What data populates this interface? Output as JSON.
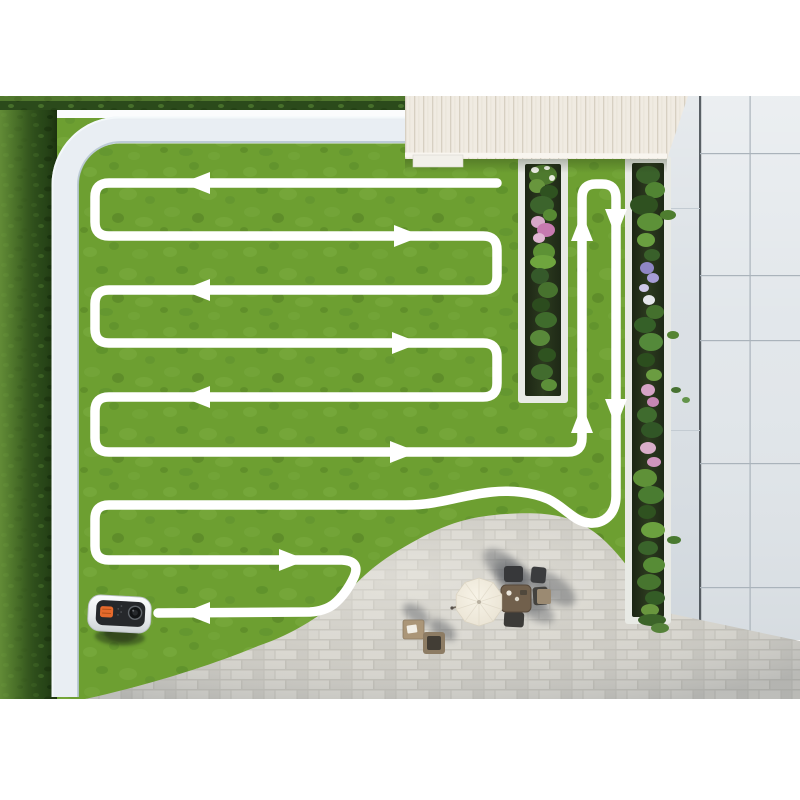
{
  "scene": {
    "description": "Aerial 3D render of a backyard showing a robotic lawn mower's serpentine mowing route",
    "frame": {
      "top": 96,
      "bottom": 699,
      "left": 0,
      "right": 800
    }
  },
  "colors": {
    "background": "#ffffff",
    "lawn": "#71a534",
    "hedge_dark": "#2b4a1b",
    "hedge_light": "#74a13f",
    "curb": "#e9eef3",
    "curb_edge": "#b6c5d1",
    "roof": "#f0ebe2",
    "roof_stripe": "#d7d0c2",
    "tile_pavement": "#e1e6ea",
    "tile_joint": "#aab3bb",
    "tile_dark_edge": "#3f464c",
    "paver_base": "#d0cec7",
    "bed_border": "#e8eae5",
    "bed_soil": "#242f1b",
    "flower_pink": "#c77ab0",
    "flower_purple": "#9a8fd0",
    "flower_white": "#eef0e8",
    "path_white": "#ffffff",
    "mower_body": "#f2f4f5",
    "mower_panel": "#26282b",
    "mower_button_orange": "#e66a2c",
    "umbrella": "#ece6d7",
    "furniture_dark": "#3b3c3e",
    "furniture_wood": "#ab9678"
  },
  "mowing_path": {
    "stroke_width": 9.5,
    "color": "#ffffff",
    "d": "M 497 183 L 109 183 Q 95 183 95 197 L 95 222 Q 95 236 109 236 L 483 236 Q 497 236 497 250 L 497 276 Q 497 290 483 290 L 109 290 Q 95 290 95 304 L 95 329 Q 95 343 109 343 L 483 343 Q 497 343 497 357 L 497 383 Q 497 397 483 397 L 109 397 Q 95 397 95 411 L 95 438 Q 95 452 109 452 L 568 452 Q 582 452 582 438 L 582 198 Q 582 184 596 184 L 602 184 Q 616 184 616 198 L 616 496 C 616 514 604 524 590 523 C 574 522 566 508 548 499 C 532 492 510 490 492 492 C 470 494 452 500 432 503 Q 420 505 406 505 L 109 505 Q 95 505 95 519 L 95 546 Q 95 560 109 560 L 342 560 Q 361 561 354 577 Q 346 594 334 604 Q 325 611 310 612 L 158 613",
    "arrows": [
      {
        "name": "row1-west",
        "t": "translate(197,183) rotate(180)"
      },
      {
        "name": "row2-east",
        "t": "translate(407,236) rotate(0)"
      },
      {
        "name": "row3-west",
        "t": "translate(197,290) rotate(180)"
      },
      {
        "name": "row4-east",
        "t": "translate(405,343) rotate(0)"
      },
      {
        "name": "row5-west",
        "t": "translate(197,397) rotate(180)"
      },
      {
        "name": "row6-east",
        "t": "translate(403,452) rotate(0)"
      },
      {
        "name": "strip-up-lower",
        "t": "translate(582,420) rotate(-90)"
      },
      {
        "name": "strip-up-upper",
        "t": "translate(582,228) rotate(-90)"
      },
      {
        "name": "strip-down-upper",
        "t": "translate(616,222) rotate(90)"
      },
      {
        "name": "strip-down-lower",
        "t": "translate(616,412) rotate(90)"
      },
      {
        "name": "row8-east",
        "t": "translate(292,560) rotate(0)"
      },
      {
        "name": "row9-west",
        "t": "translate(197,613) rotate(180)"
      }
    ]
  },
  "objects": {
    "mower": {
      "label": "robot lawn mower",
      "x": 88,
      "y": 595,
      "heading": "west"
    },
    "hedge": {
      "label": "boxwood hedge border"
    },
    "curb": {
      "label": "white garden curb"
    },
    "roof": {
      "label": "house roof with plank texture"
    },
    "left_bed": {
      "label": "raised flower bed (left)"
    },
    "right_bed": {
      "label": "raised flower bed (right)"
    },
    "tile_area": {
      "label": "large slab pavement"
    },
    "patio": {
      "label": "brick paver patio"
    },
    "furniture": {
      "label": "patio dining set with parasol"
    }
  }
}
